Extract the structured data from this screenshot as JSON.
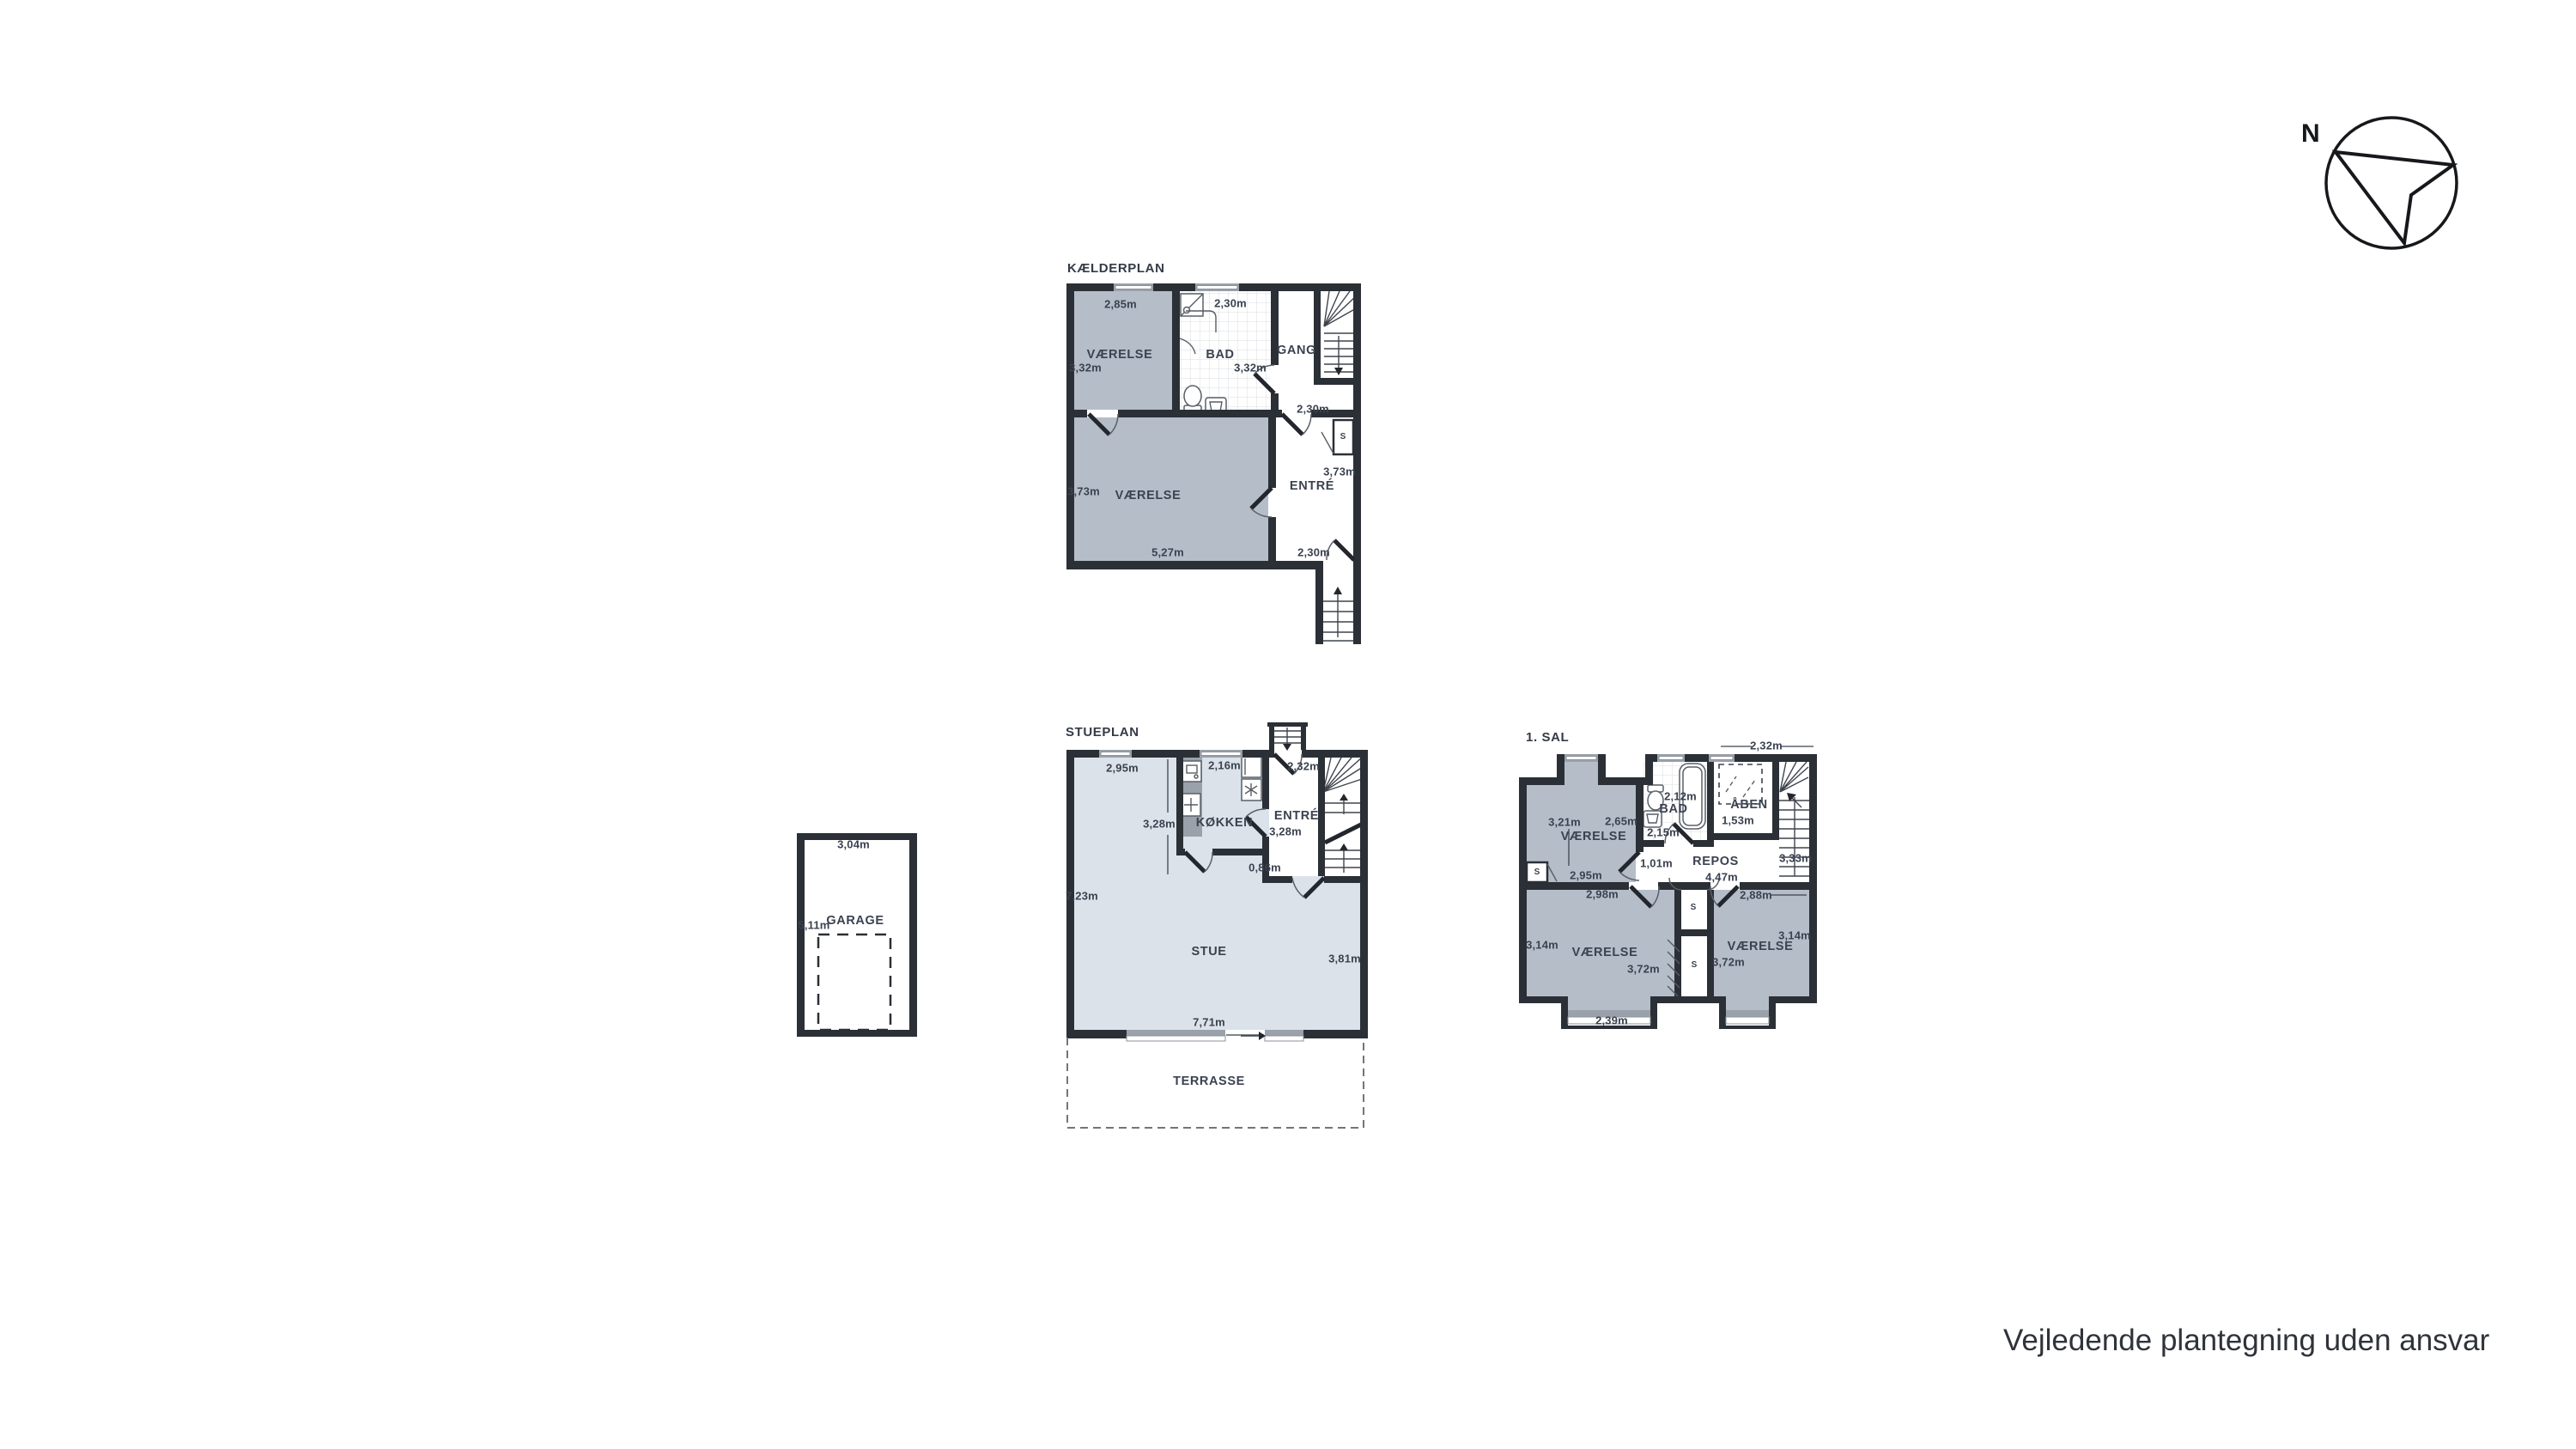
{
  "page": {
    "disclaimer": "Vejledende plantegning uden ansvar"
  },
  "compass": {
    "north_label": "N"
  },
  "kaelderplan": {
    "title": "KÆLDERPLAN",
    "vaerelse_top": {
      "label": "VÆRELSE",
      "width": "2,85m",
      "depth": "3,32m"
    },
    "bad": {
      "label": "BAD",
      "width": "2,30m",
      "depth": "3,32m"
    },
    "gang": {
      "label": "GANG"
    },
    "entre": {
      "label": "ENTRÉ",
      "width_top": "2,30m",
      "depth": "3,73m",
      "width_bottom": "2,30m",
      "closet": "S"
    },
    "vaerelse_bottom": {
      "label": "VÆRELSE",
      "depth": "3,73m",
      "width": "5,27m"
    }
  },
  "stueplan": {
    "title": "STUEPLAN",
    "koekken": {
      "label": "KØKKEN",
      "width": "2,16m",
      "left_width": "2,95m",
      "depth": "3,28m"
    },
    "entre": {
      "label": "ENTRÉ",
      "width": "2,32m",
      "depth": "3,28m",
      "passage": "0,86m"
    },
    "stue": {
      "label": "STUE",
      "height_left": "7,23m",
      "depth_right": "3,81m",
      "width_bottom": "7,71m"
    },
    "terrasse": {
      "label": "TERRASSE"
    }
  },
  "foerste_sal": {
    "title": "1. SAL",
    "dim_top_right": "2,32m",
    "vaerelse_nw": {
      "label": "VÆRELSE",
      "depth": "3,21m",
      "width": "2,65m",
      "width_bottom": "2,95m",
      "closet": "S"
    },
    "bad": {
      "label": "BAD",
      "width": "2,12m",
      "width_inner": "2,15m"
    },
    "aaben": {
      "label": "ÅBEN",
      "width": "1,53m"
    },
    "repos": {
      "label": "REPOS",
      "passage": "1,01m",
      "width": "4,47m",
      "depth": "3,33m"
    },
    "vaerelse_sw": {
      "label": "VÆRELSE",
      "width_top": "2,98m",
      "depth_left": "3,14m",
      "depth_right": "3,72m",
      "width_bottom": "2,39m"
    },
    "vaerelse_se": {
      "label": "VÆRELSE",
      "width_top": "2,88m",
      "depth_right": "3,14m",
      "depth_left": "3,72m"
    },
    "closet_upper": "S",
    "closet_lower": "S"
  },
  "garage": {
    "label": "GARAGE",
    "width": "3,04m",
    "depth": "5,11m"
  }
}
